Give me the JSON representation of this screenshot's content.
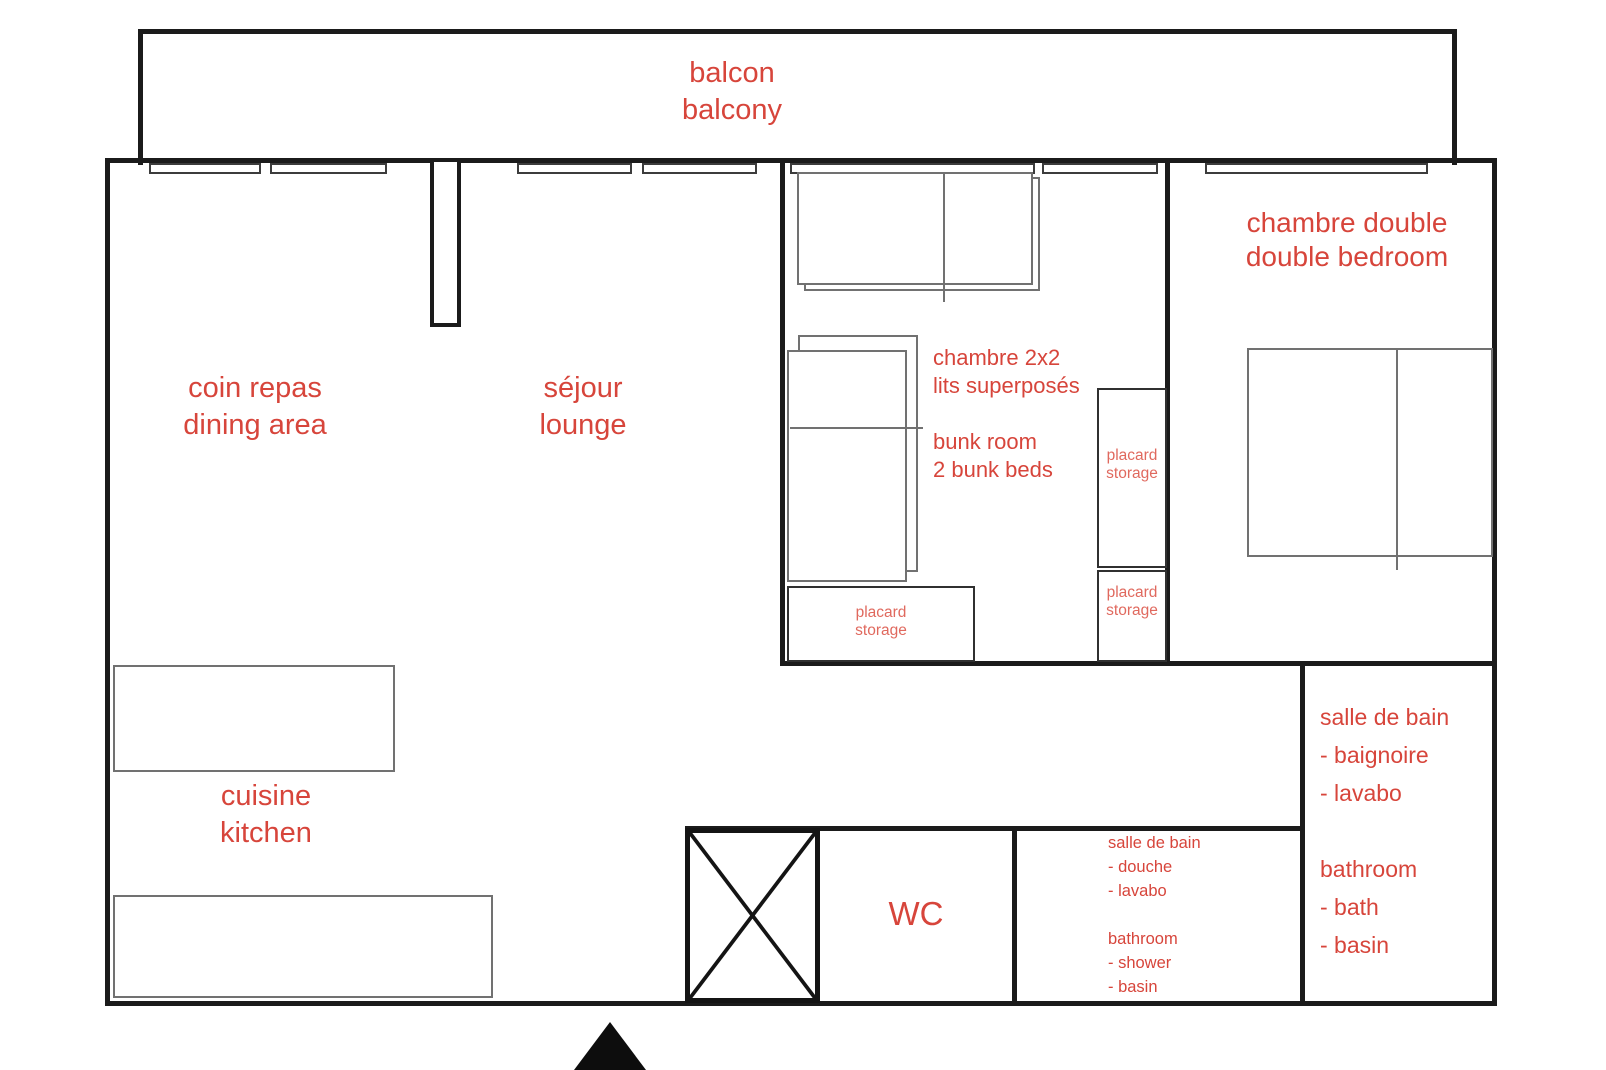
{
  "colors": {
    "wall": "#1b1b1b",
    "furniture_outline": "#717171",
    "label_red": "#d7453b",
    "label_red_soft": "#e0695e",
    "background": "#ffffff"
  },
  "plan": {
    "balcony": {
      "fr": "balcon",
      "en": "balcony"
    },
    "dining_area": {
      "fr": "coin repas",
      "en": "dining area"
    },
    "lounge": {
      "fr": "séjour",
      "en": "lounge"
    },
    "kitchen": {
      "fr": "cuisine",
      "en": "kitchen"
    },
    "bunk_room": {
      "fr_line1": "chambre 2x2",
      "fr_line2": "lits superposés",
      "en_line1": "bunk room",
      "en_line2": "2 bunk beds"
    },
    "double_bedroom": {
      "fr": "chambre double",
      "en": "double bedroom"
    },
    "wc": {
      "label": "WC"
    },
    "storage": {
      "fr": "placard",
      "en": "storage"
    },
    "bathroom_bath": {
      "fr_title": "salle de bain",
      "fr_item1": "- baignoire",
      "fr_item2": "- lavabo",
      "en_title": "bathroom",
      "en_item1": "- bath",
      "en_item2": "- basin"
    },
    "bathroom_shower": {
      "fr_title": "salle de bain",
      "fr_item1": "- douche",
      "fr_item2": "- lavabo",
      "en_title": "bathroom",
      "en_item1": "- shower",
      "en_item2": "- basin"
    }
  }
}
